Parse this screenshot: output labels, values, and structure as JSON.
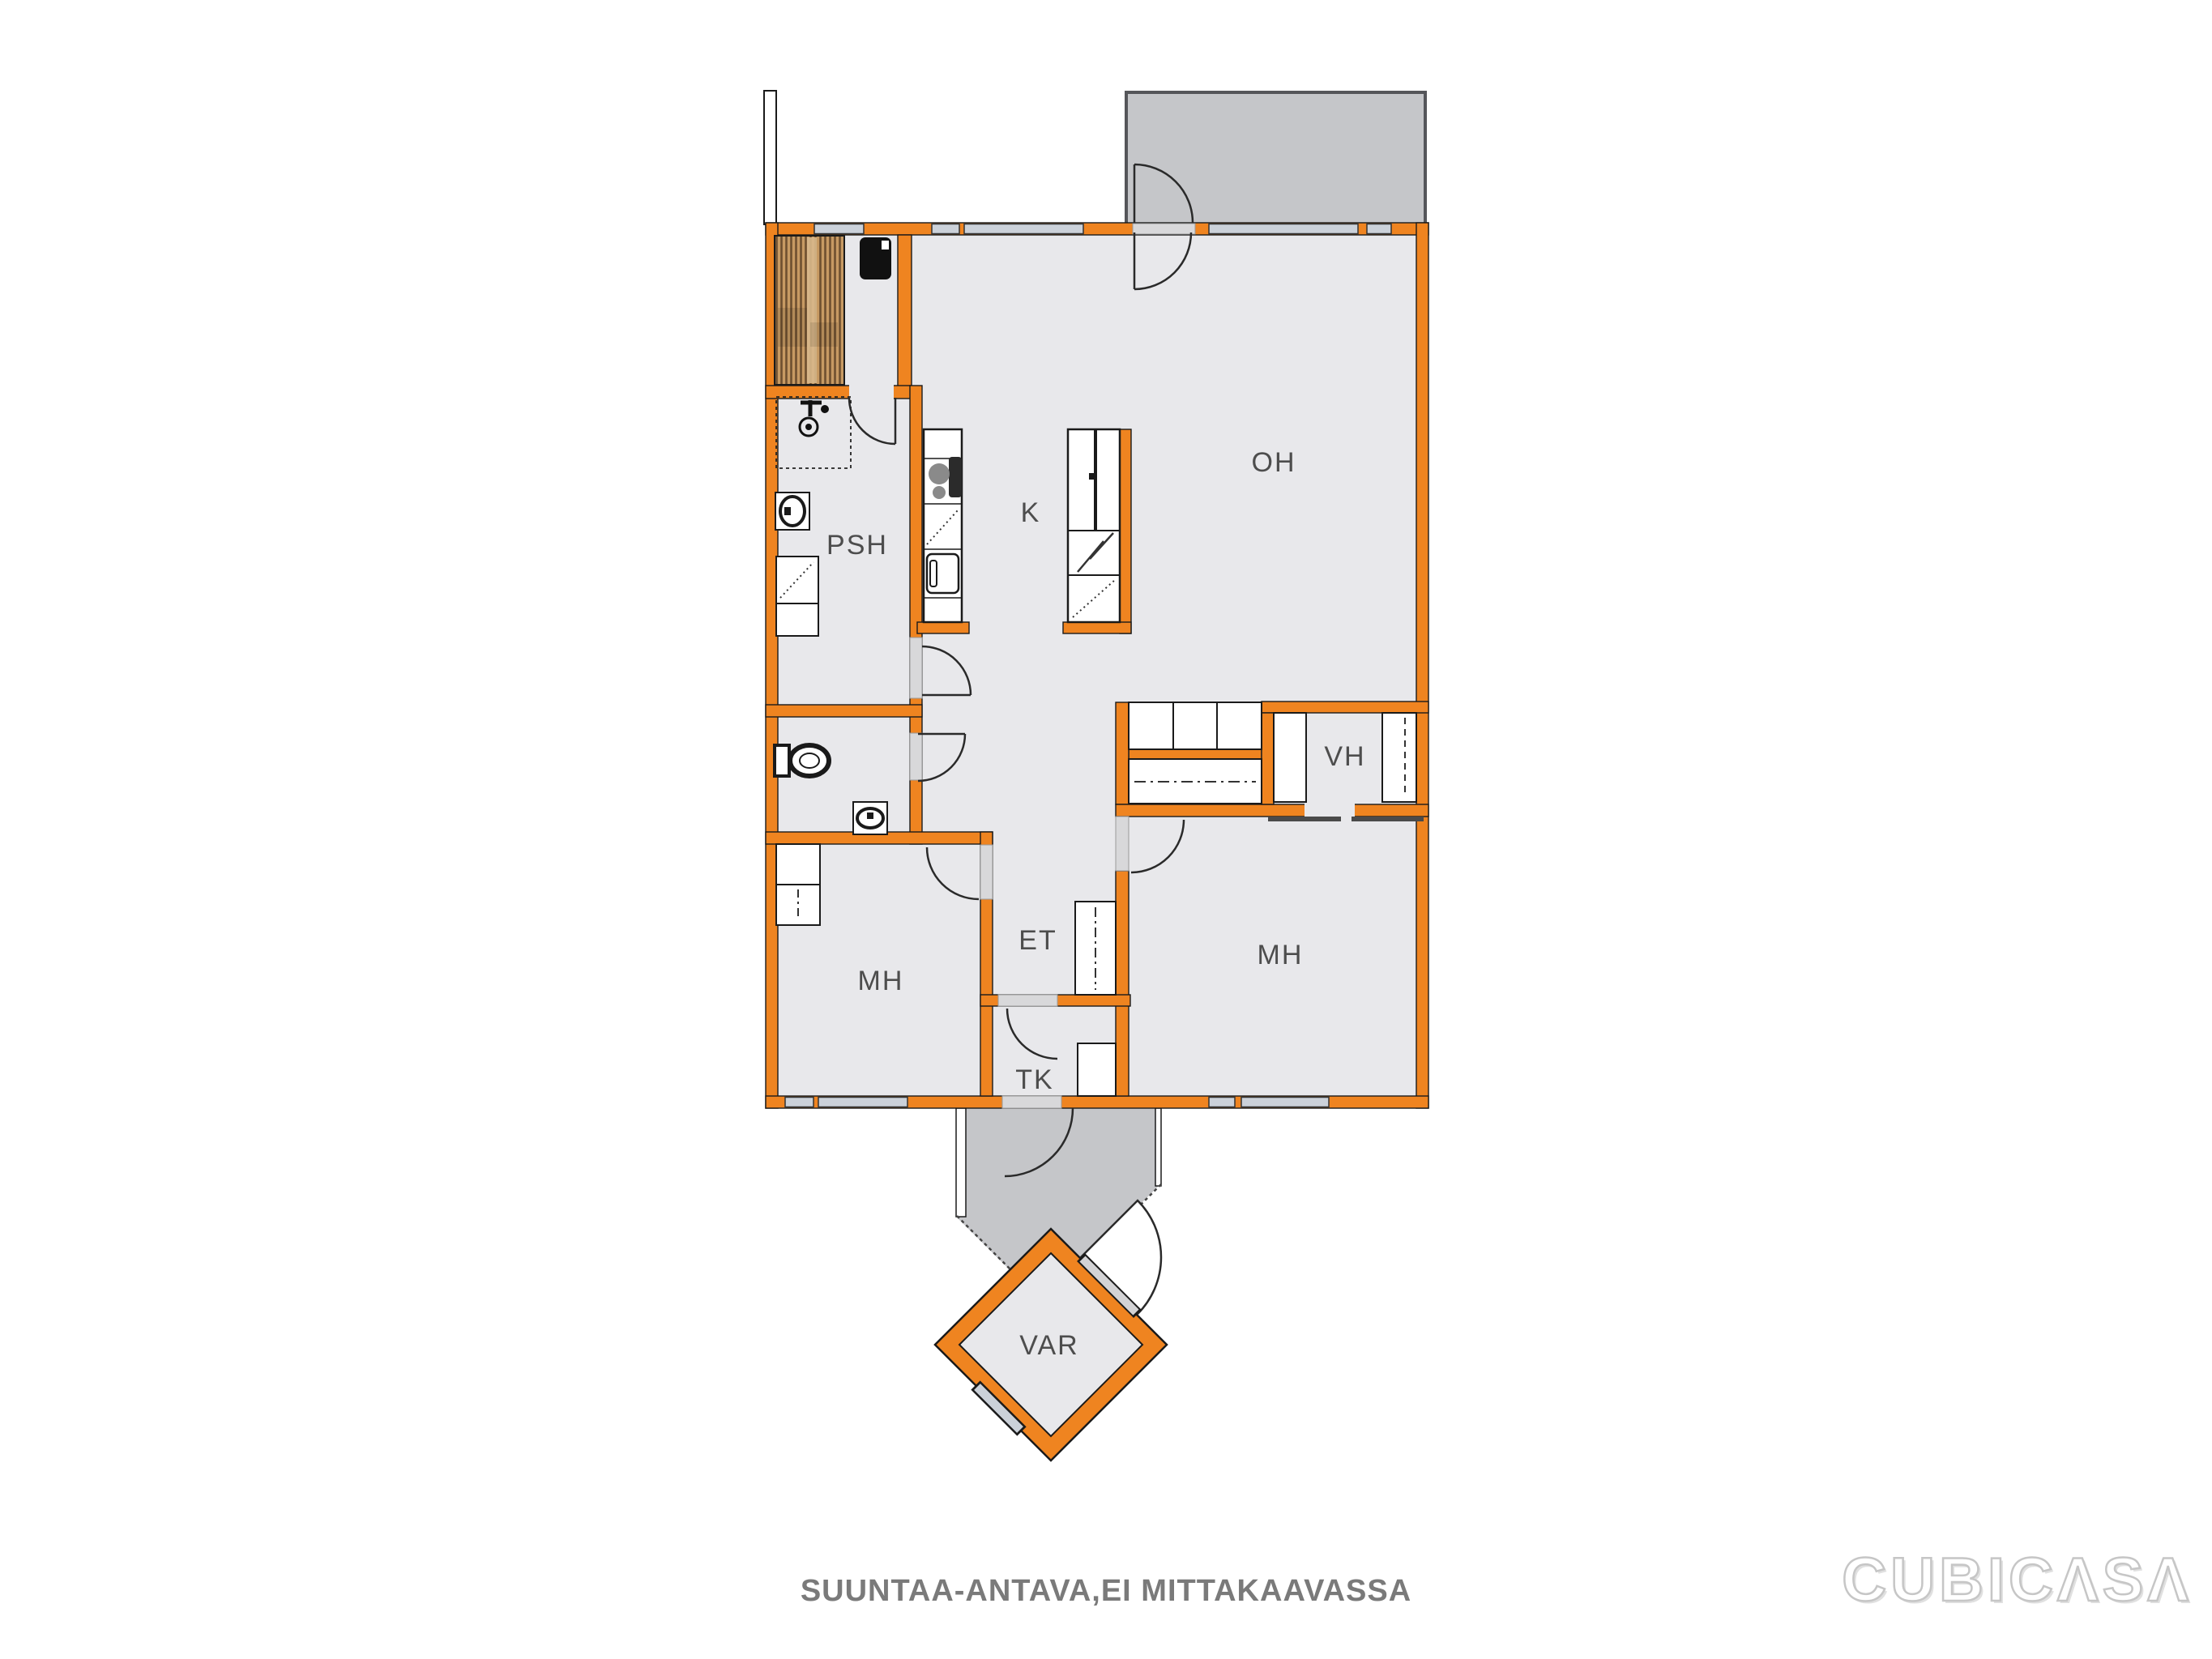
{
  "rooms": {
    "oh": "OH",
    "k": "K",
    "psh": "PSH",
    "vh": "VH",
    "mh_left": "MH",
    "mh_right": "MH",
    "et": "ET",
    "tk": "TK",
    "var": "VAR"
  },
  "caption": "SUUNTAA-ANTAVA,EI MITTAKAAVASSA",
  "watermark": "CUBICΛSΛ",
  "fixtures": [
    "sauna-stove",
    "sauna-benches",
    "shower",
    "hand-sink",
    "washing-machine",
    "toilet",
    "cooktop",
    "oven",
    "fridge-freezer",
    "dishwasher",
    "wardrobe",
    "shelf-closet"
  ],
  "colors": {
    "wall_orange": "#EF8420",
    "window_fill": "#CBD1D9",
    "room_fill": "#E8E8EB",
    "outdoor_gray": "#C5C6C9",
    "threshold_gray": "#D8D8DA",
    "sauna_wood": "#C79A63",
    "caption_gray": "#7A7A7A"
  }
}
